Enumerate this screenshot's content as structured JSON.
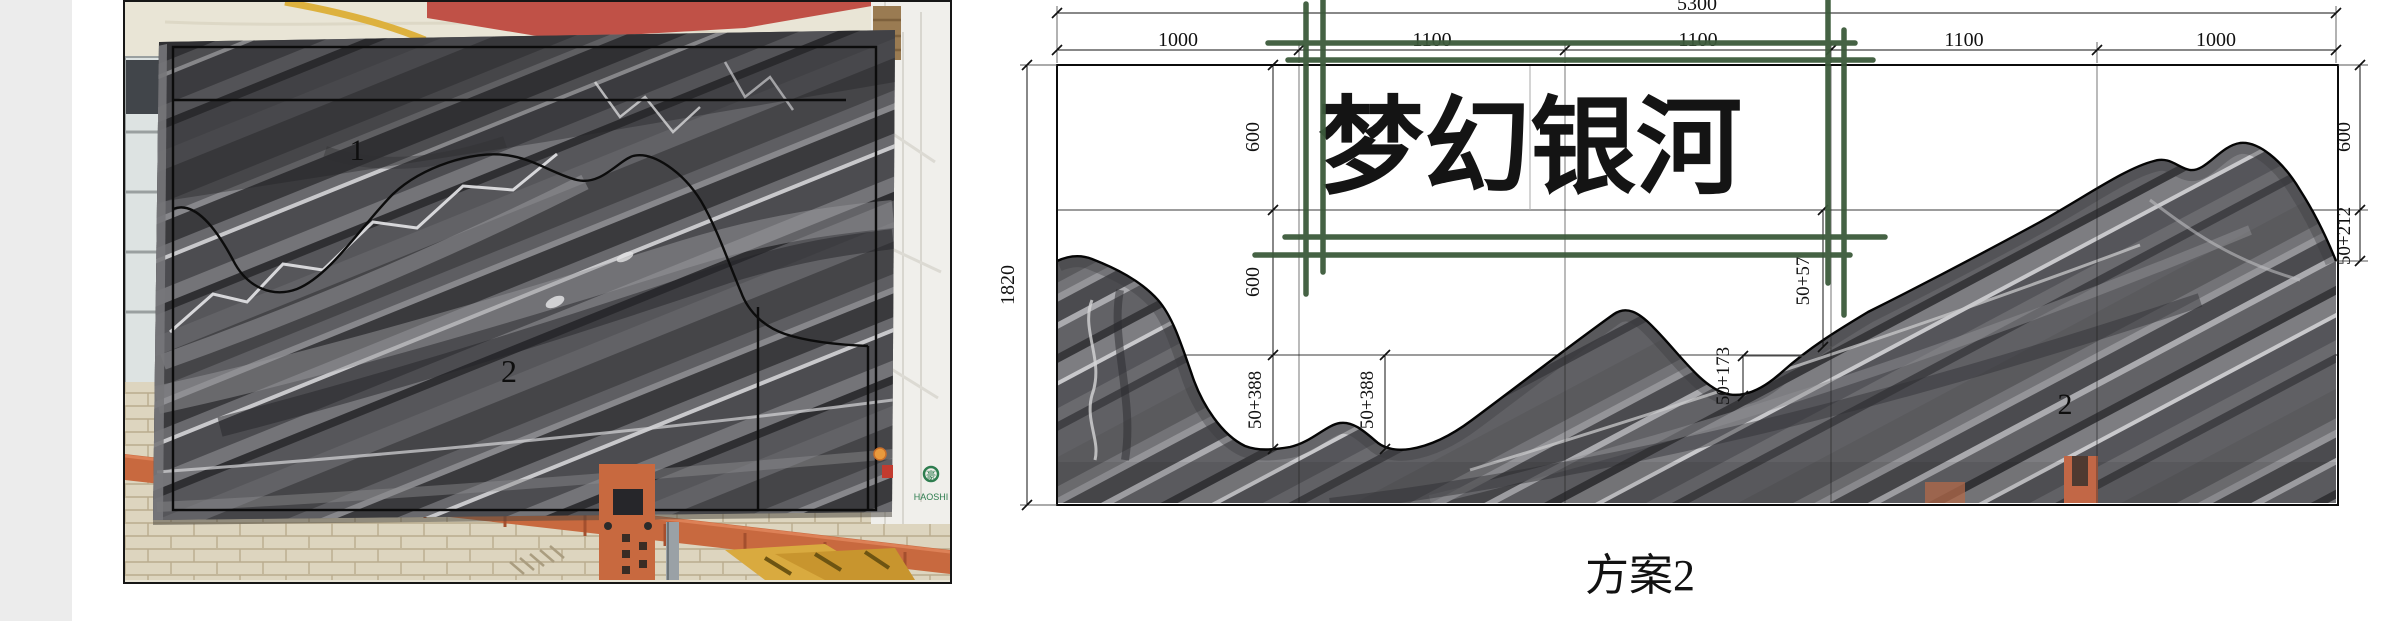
{
  "photo": {
    "piece1_label": "1",
    "piece2_label": "2",
    "logo_text": "HAOSHI",
    "logo_mark": "豪"
  },
  "drawing": {
    "title": "梦幻银河",
    "plan_label": "方案2",
    "piece_label": "2",
    "dims": {
      "total": "5300",
      "height": "1820",
      "seg1": "1000",
      "seg2": "1100",
      "seg3": "1100",
      "seg4": "1100",
      "seg5": "1000",
      "left_r1": "600",
      "left_r2": "600",
      "left_r3": "50+388",
      "mid_valley": "50+388",
      "mid_saddle": "50+173",
      "mid_slope": "50+57",
      "right_r1": "600",
      "right_r2": "50+212"
    },
    "colors": {
      "annotation_green": "#3c5a3b",
      "dim_line": "#111111",
      "marble_base": "#57575b",
      "crane_orange": "#c8693f",
      "ceiling_red": "#c05147",
      "stripe_yellow": "#ddb13e"
    }
  }
}
